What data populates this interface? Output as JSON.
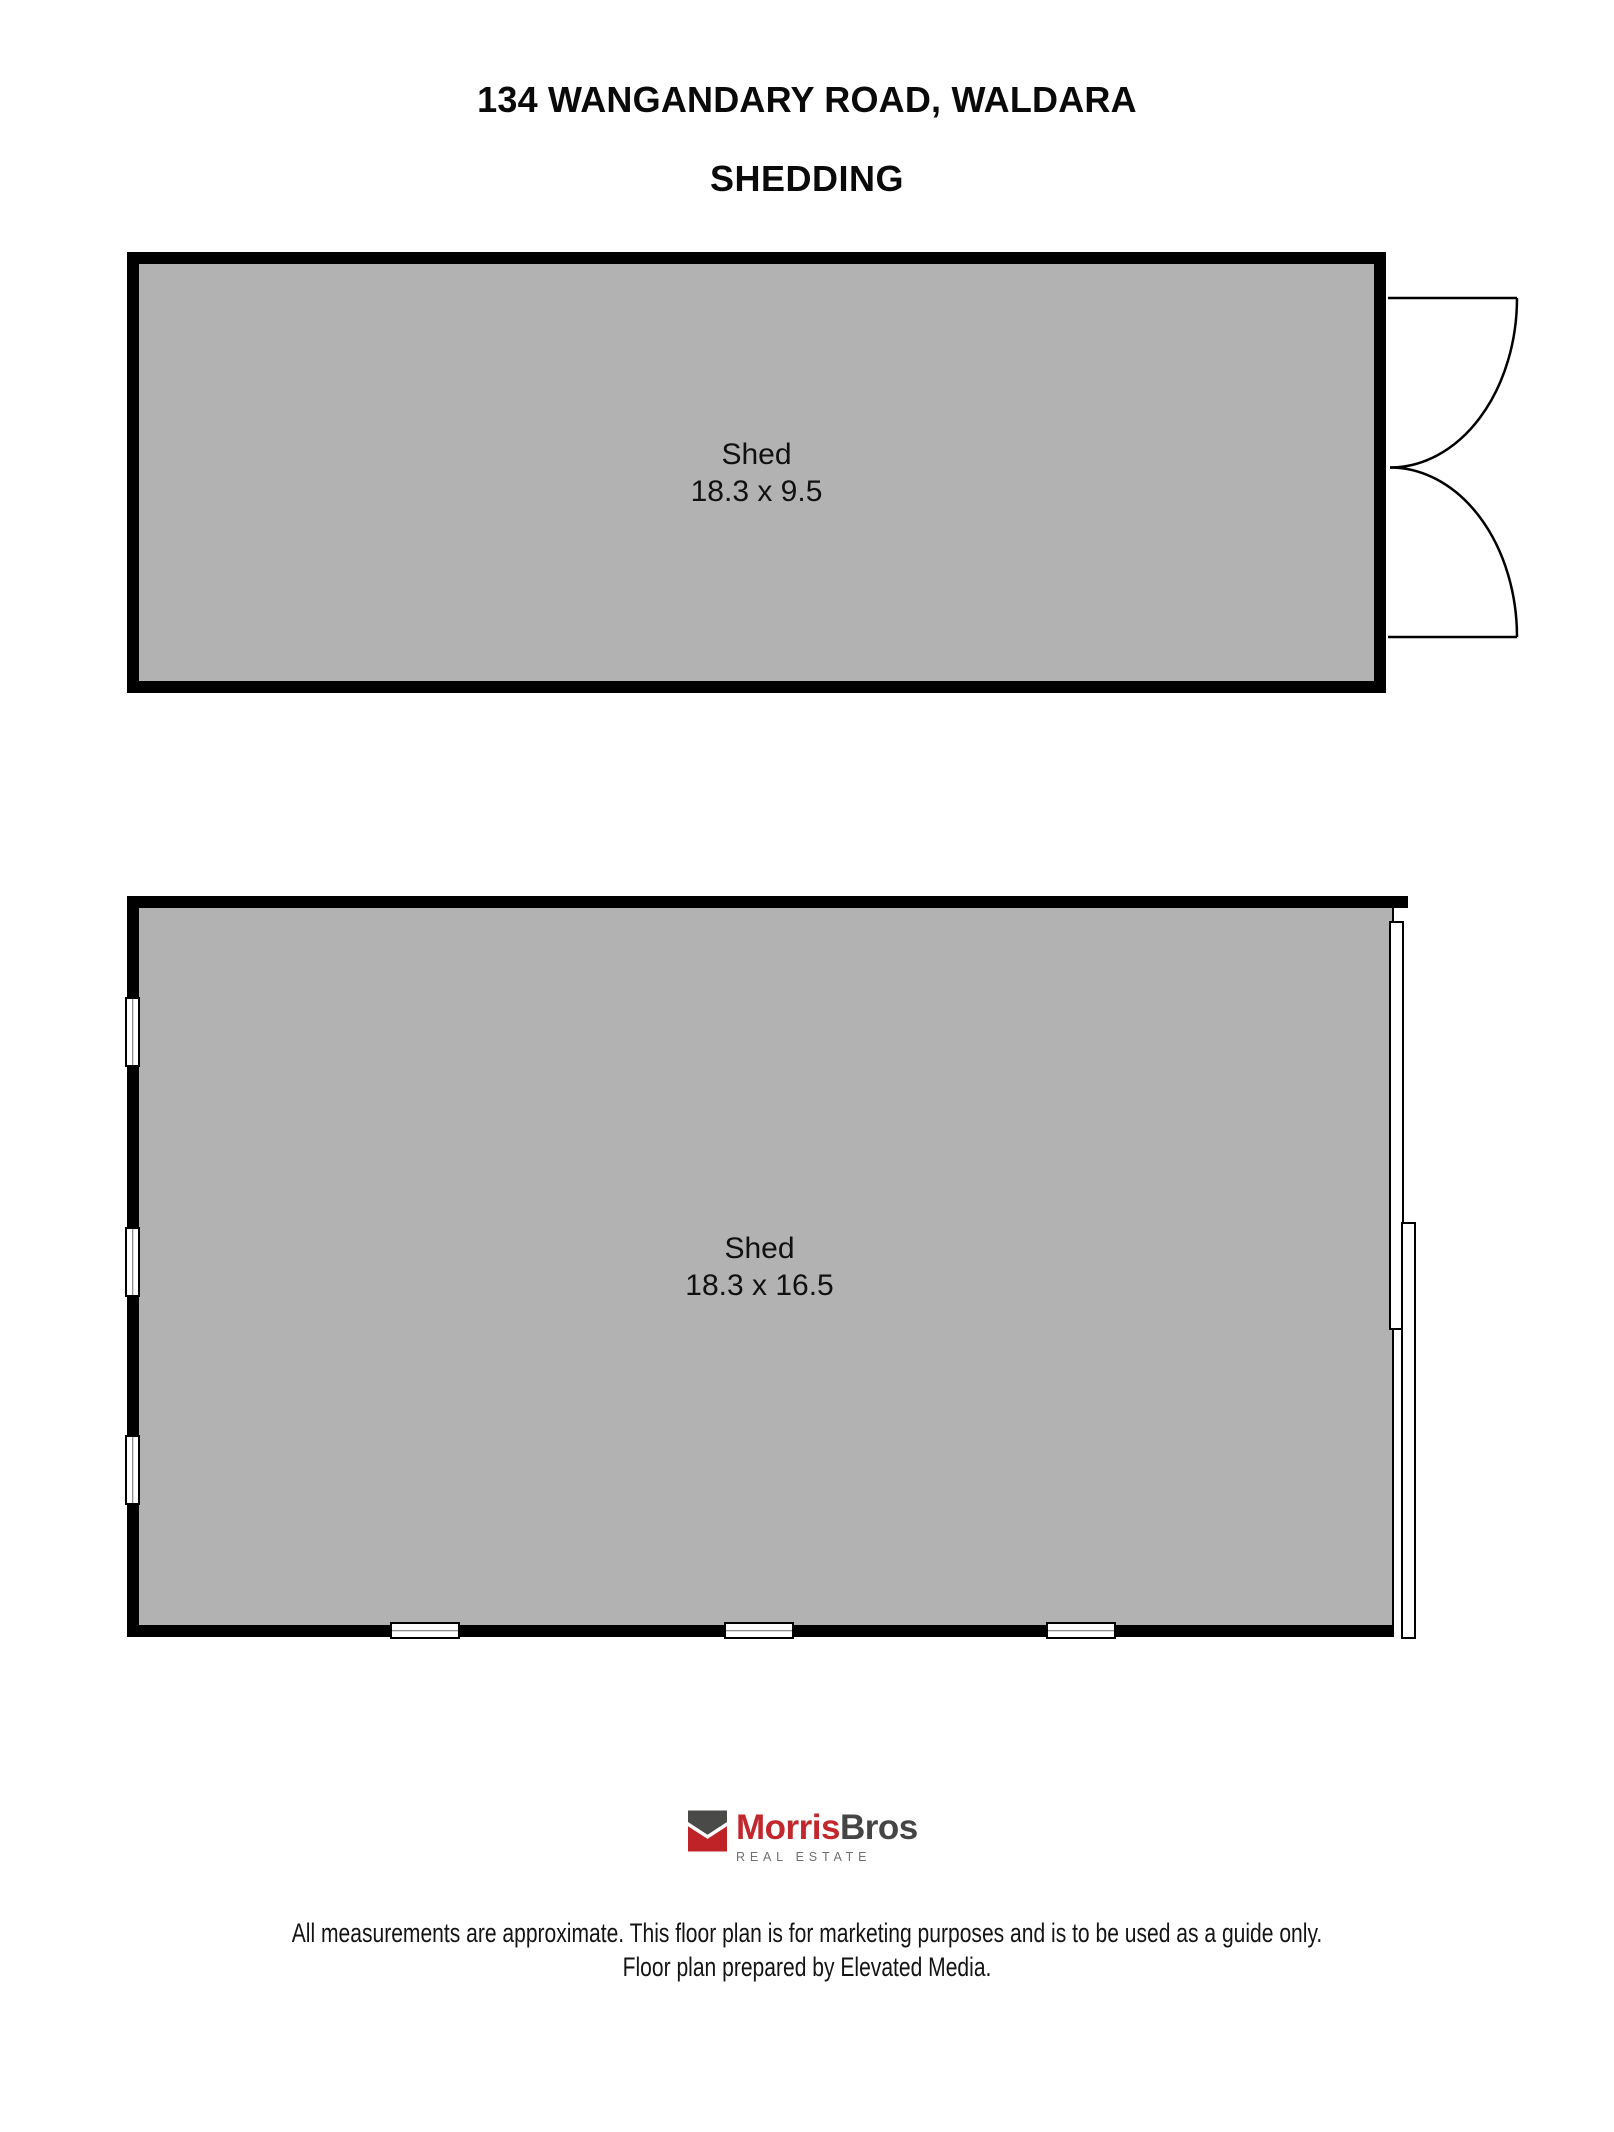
{
  "page": {
    "title": "134 WANGANDARY ROAD, WALDARA",
    "subtitle": "SHEDDING"
  },
  "sheds": [
    {
      "name": "Shed",
      "dimensions": "18.3 x 9.5",
      "features": [
        "double-swing-door-right"
      ]
    },
    {
      "name": "Shed",
      "dimensions": "18.3 x 16.5",
      "features": [
        "three-windows-left-wall",
        "three-windows-bottom-wall",
        "sliding-door-right-wall"
      ]
    }
  ],
  "logo": {
    "brand_primary": "Morris",
    "brand_secondary": "Bros",
    "tagline": "R E A L   E S T A T E"
  },
  "footer": {
    "line1": "All measurements are approximate. This floor plan is for marketing purposes and is to be used as a guide only.",
    "line2": "Floor plan prepared by Elevated Media."
  },
  "colors": {
    "wall": "#000000",
    "floor_fill": "#b2b2b2",
    "brand_red": "#c1272d",
    "brand_dark": "#454545",
    "tagline_gray": "#6f6f6f"
  }
}
